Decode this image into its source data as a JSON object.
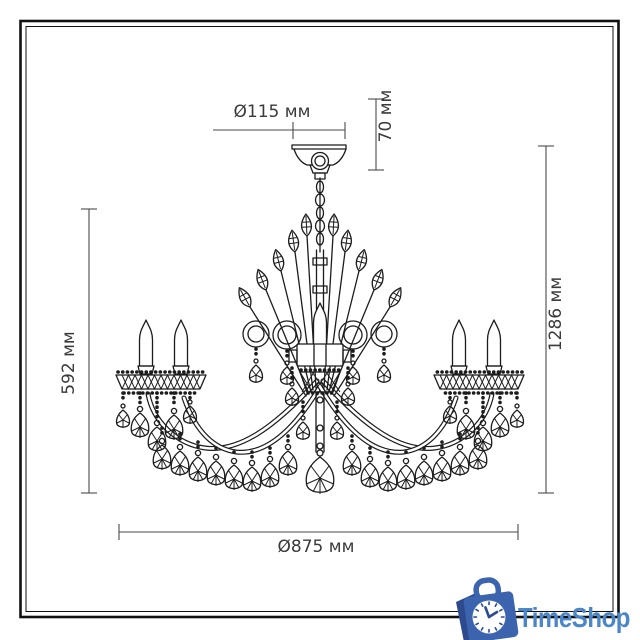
{
  "drawing": {
    "dimensions": {
      "canopy_diameter": "Ø115 мм",
      "canopy_height": "70 мм",
      "body_height": "592 мм",
      "total_height": "1286 мм",
      "width": "Ø875 мм"
    }
  },
  "branding": {
    "name": "TimeShop"
  },
  "colors": {
    "line": "#1c1c1c",
    "dimension_line": "#4a4a4a",
    "dimension_text": "#3a3a3a",
    "brand_text": "#4a86c8",
    "brand_bag": "#3b63ae",
    "brand_bag_dark": "#2c4a8d",
    "background": "#ffffff"
  }
}
